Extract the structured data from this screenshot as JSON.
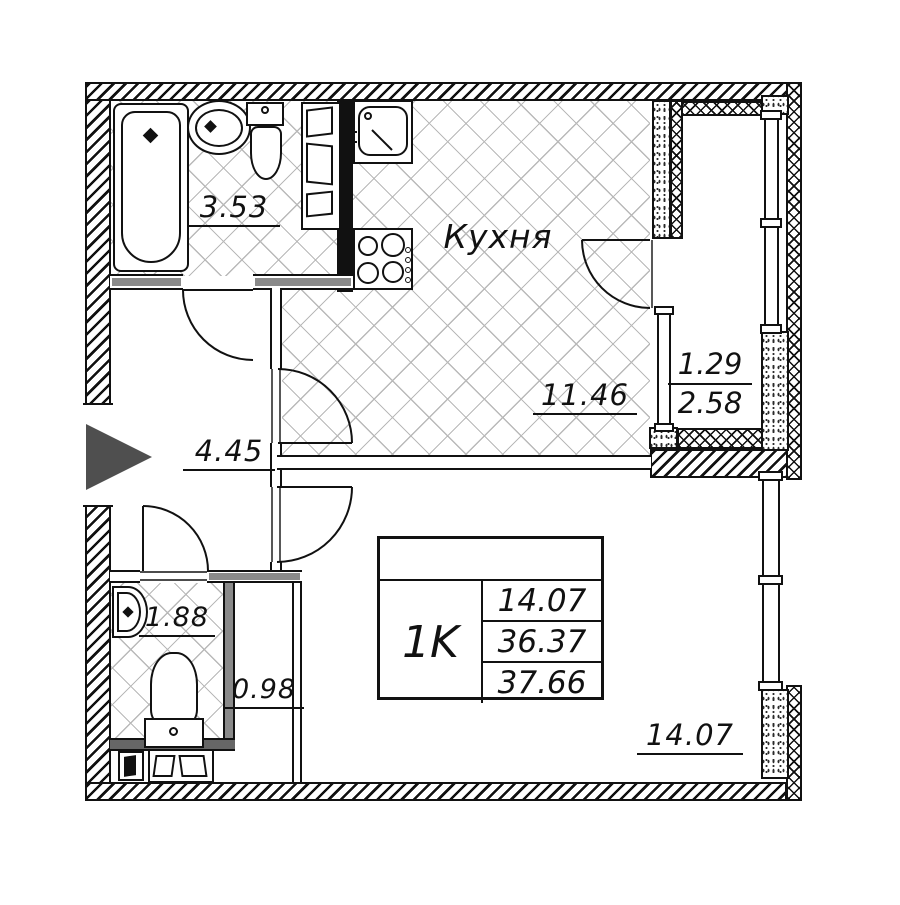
{
  "plan": {
    "type_label": "Floor plan of 1-room apartment",
    "rooms": {
      "bathroom": {
        "area": "3.53"
      },
      "kitchen": {
        "name": "Кухня",
        "area": "11.46"
      },
      "balcony": {
        "area_reduced": "1.29",
        "area_full": "2.58"
      },
      "hallway": {
        "area": "4.45"
      },
      "wc": {
        "area": "1.88"
      },
      "closet": {
        "area": "0.98"
      },
      "living_room": {
        "area": "14.07"
      }
    },
    "info_table": {
      "apartment_type": "1K",
      "living_area": "14.07",
      "apartment_area": "36.37",
      "total_area": "37.66"
    },
    "colors": {
      "line": "#111111",
      "floor_hatch": "#b9b9b9",
      "wall_gray": "#8a8a8a",
      "entrance_arrow": "#4f4f4f",
      "background": "#ffffff"
    }
  }
}
